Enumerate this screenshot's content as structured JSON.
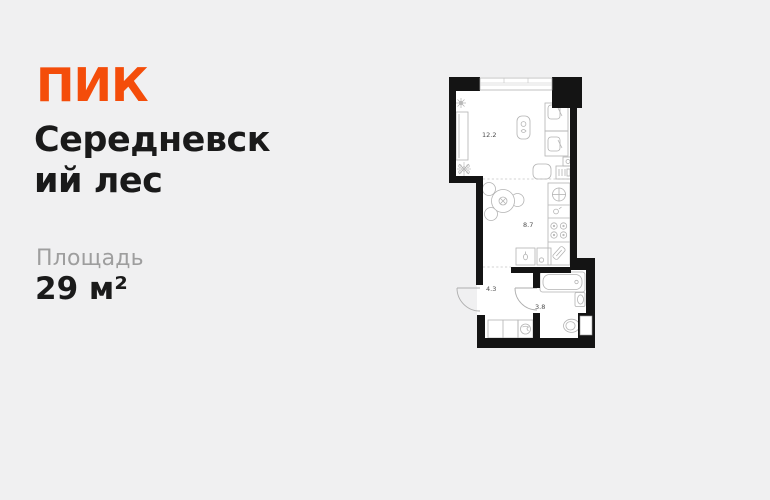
{
  "brand": {
    "logo_text": "ПИК",
    "accent_color": "#F44D0A"
  },
  "project": {
    "name": "Середневский лес",
    "name_lines": [
      "Середневск",
      "ий лес"
    ]
  },
  "area": {
    "label": "Площадь",
    "value": "29 м²"
  },
  "floor_plan": {
    "rooms": [
      {
        "id": "living-room",
        "area_label": "12.2"
      },
      {
        "id": "kitchen",
        "area_label": "8.7"
      },
      {
        "id": "hallway",
        "area_label": "4.3"
      },
      {
        "id": "bathroom",
        "area_label": "3.8"
      }
    ],
    "colors": {
      "wall": "#141414",
      "floor": "#ffffff",
      "furniture_outline": "#b3b3b3",
      "background": "#f0f0f1"
    }
  }
}
